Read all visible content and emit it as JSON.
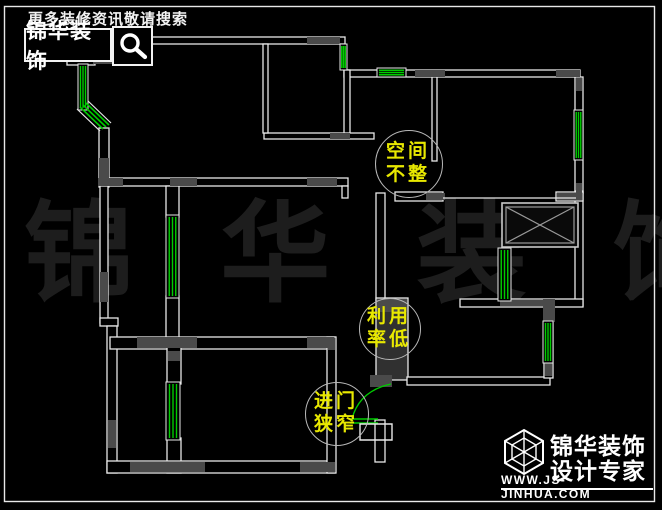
{
  "meta": {
    "width": 662,
    "height": 510,
    "background": "#000000"
  },
  "colors": {
    "wall": "#e8e8e8",
    "pier": "#4a4a4a",
    "window": "#00cc00",
    "circle": "#b8b8b8",
    "annotation_text": "#e8e800",
    "watermark": "#1d1d1d",
    "frame": "#e8e8e8"
  },
  "header": {
    "tagline": "更多装修资讯敬请搜索",
    "brand": "锦华装饰",
    "search_icon": "magnifier-icon"
  },
  "watermark": {
    "text": "锦 华  装 饰"
  },
  "annotations": [
    {
      "id": "space-irregular",
      "line1": "空间",
      "line2": "不整",
      "cx": 408,
      "cy": 163,
      "r": 33
    },
    {
      "id": "low-utilization",
      "line1": "利用",
      "line2": "率低",
      "cx": 389,
      "cy": 328,
      "r": 30
    },
    {
      "id": "narrow-entrance",
      "line1": "进门",
      "line2": "狭窄",
      "cx": 336,
      "cy": 413,
      "r": 31
    }
  ],
  "logo": {
    "line1": "锦华装饰",
    "line2": "设计专家",
    "url": "WWW.JS-JINHUA.COM"
  },
  "floorplan": {
    "frame": [
      4,
      6,
      650,
      495
    ],
    "walls": [
      [
        75,
        37,
        270,
        7
      ],
      [
        344,
        70,
        236,
        7
      ],
      [
        575,
        77,
        8,
        116
      ],
      [
        575,
        191,
        8,
        115
      ],
      [
        395,
        192,
        48,
        9
      ],
      [
        556,
        192,
        27,
        9
      ],
      [
        432,
        77,
        5,
        84
      ],
      [
        344,
        70,
        6,
        65
      ],
      [
        264,
        133,
        110,
        6
      ],
      [
        263,
        44,
        5,
        89
      ],
      [
        100,
        178,
        248,
        8
      ],
      [
        342,
        186,
        6,
        12
      ],
      [
        67,
        58,
        28,
        7
      ],
      [
        99,
        128,
        10,
        59
      ],
      [
        100,
        186,
        8,
        137
      ],
      [
        166,
        186,
        13,
        31
      ],
      [
        166,
        296,
        13,
        43
      ],
      [
        100,
        318,
        18,
        8
      ],
      [
        107,
        326,
        10,
        147
      ],
      [
        110,
        337,
        225,
        12
      ],
      [
        167,
        347,
        14,
        37
      ],
      [
        167,
        438,
        14,
        35
      ],
      [
        107,
        461,
        228,
        12
      ],
      [
        327,
        337,
        9,
        136
      ],
      [
        376,
        193,
        9,
        107
      ],
      [
        376,
        298,
        32,
        82,
        "#303030"
      ],
      [
        407,
        377,
        143,
        8
      ],
      [
        544,
        304,
        9,
        74
      ],
      [
        460,
        299,
        123,
        8
      ],
      [
        375,
        420,
        10,
        42
      ]
    ],
    "piers": [
      [
        307,
        37,
        33,
        7
      ],
      [
        93,
        44,
        24,
        20
      ],
      [
        99,
        158,
        10,
        28
      ],
      [
        100,
        272,
        8,
        30
      ],
      [
        98,
        178,
        25,
        8
      ],
      [
        170,
        178,
        27,
        8
      ],
      [
        307,
        178,
        30,
        8
      ],
      [
        330,
        133,
        20,
        6
      ],
      [
        415,
        70,
        30,
        7
      ],
      [
        556,
        70,
        24,
        7
      ],
      [
        576,
        78,
        6,
        13
      ],
      [
        576,
        183,
        6,
        13
      ],
      [
        426,
        193,
        19,
        7
      ],
      [
        557,
        193,
        25,
        7
      ],
      [
        137,
        337,
        60,
        11
      ],
      [
        307,
        337,
        27,
        11
      ],
      [
        130,
        462,
        75,
        10
      ],
      [
        300,
        462,
        35,
        10
      ],
      [
        328,
        338,
        7,
        12
      ],
      [
        108,
        420,
        8,
        28
      ],
      [
        168,
        351,
        12,
        10
      ],
      [
        500,
        300,
        46,
        6
      ],
      [
        543,
        299,
        12,
        23
      ],
      [
        545,
        362,
        7,
        14
      ],
      [
        370,
        375,
        22,
        12
      ],
      [
        377,
        299,
        30,
        13
      ]
    ],
    "windows": [
      {
        "x": 78,
        "y": 64,
        "w": 10,
        "h": 46,
        "dir": "v"
      },
      {
        "x": 166,
        "y": 215,
        "w": 13,
        "h": 83,
        "dir": "v"
      },
      {
        "x": 166,
        "y": 382,
        "w": 14,
        "h": 58,
        "dir": "v"
      },
      {
        "x": 574,
        "y": 110,
        "w": 9,
        "h": 50,
        "dir": "v"
      },
      {
        "x": 498,
        "y": 248,
        "w": 13,
        "h": 53,
        "dir": "v"
      },
      {
        "x": 543,
        "y": 321,
        "w": 10,
        "h": 42,
        "dir": "v"
      },
      {
        "x": 377,
        "y": 68,
        "w": 29,
        "h": 9,
        "dir": "h"
      },
      {
        "x": 340,
        "y": 44,
        "w": 7,
        "h": 26,
        "dir": "v"
      }
    ],
    "green_lines": [
      [
        80,
        107,
        103,
        129
      ],
      [
        83,
        105,
        106,
        127
      ],
      [
        86,
        103,
        109,
        125
      ],
      [
        350,
        419,
        378,
        419
      ],
      [
        350,
        423,
        378,
        423
      ]
    ],
    "white_lines": [
      [
        443,
        198,
        576,
        198
      ],
      [
        77,
        109,
        100,
        131
      ],
      [
        88,
        101,
        111,
        123
      ]
    ],
    "paths": [
      {
        "d": "M352,419 Q359,391 391,384",
        "stroke": "green"
      },
      {
        "d": "M360,424 L392,424 L392,440 L360,440 Z",
        "stroke": "white"
      }
    ],
    "elevator": {
      "x": 502,
      "y": 203,
      "w": 76,
      "h": 44,
      "inset": 4
    }
  }
}
